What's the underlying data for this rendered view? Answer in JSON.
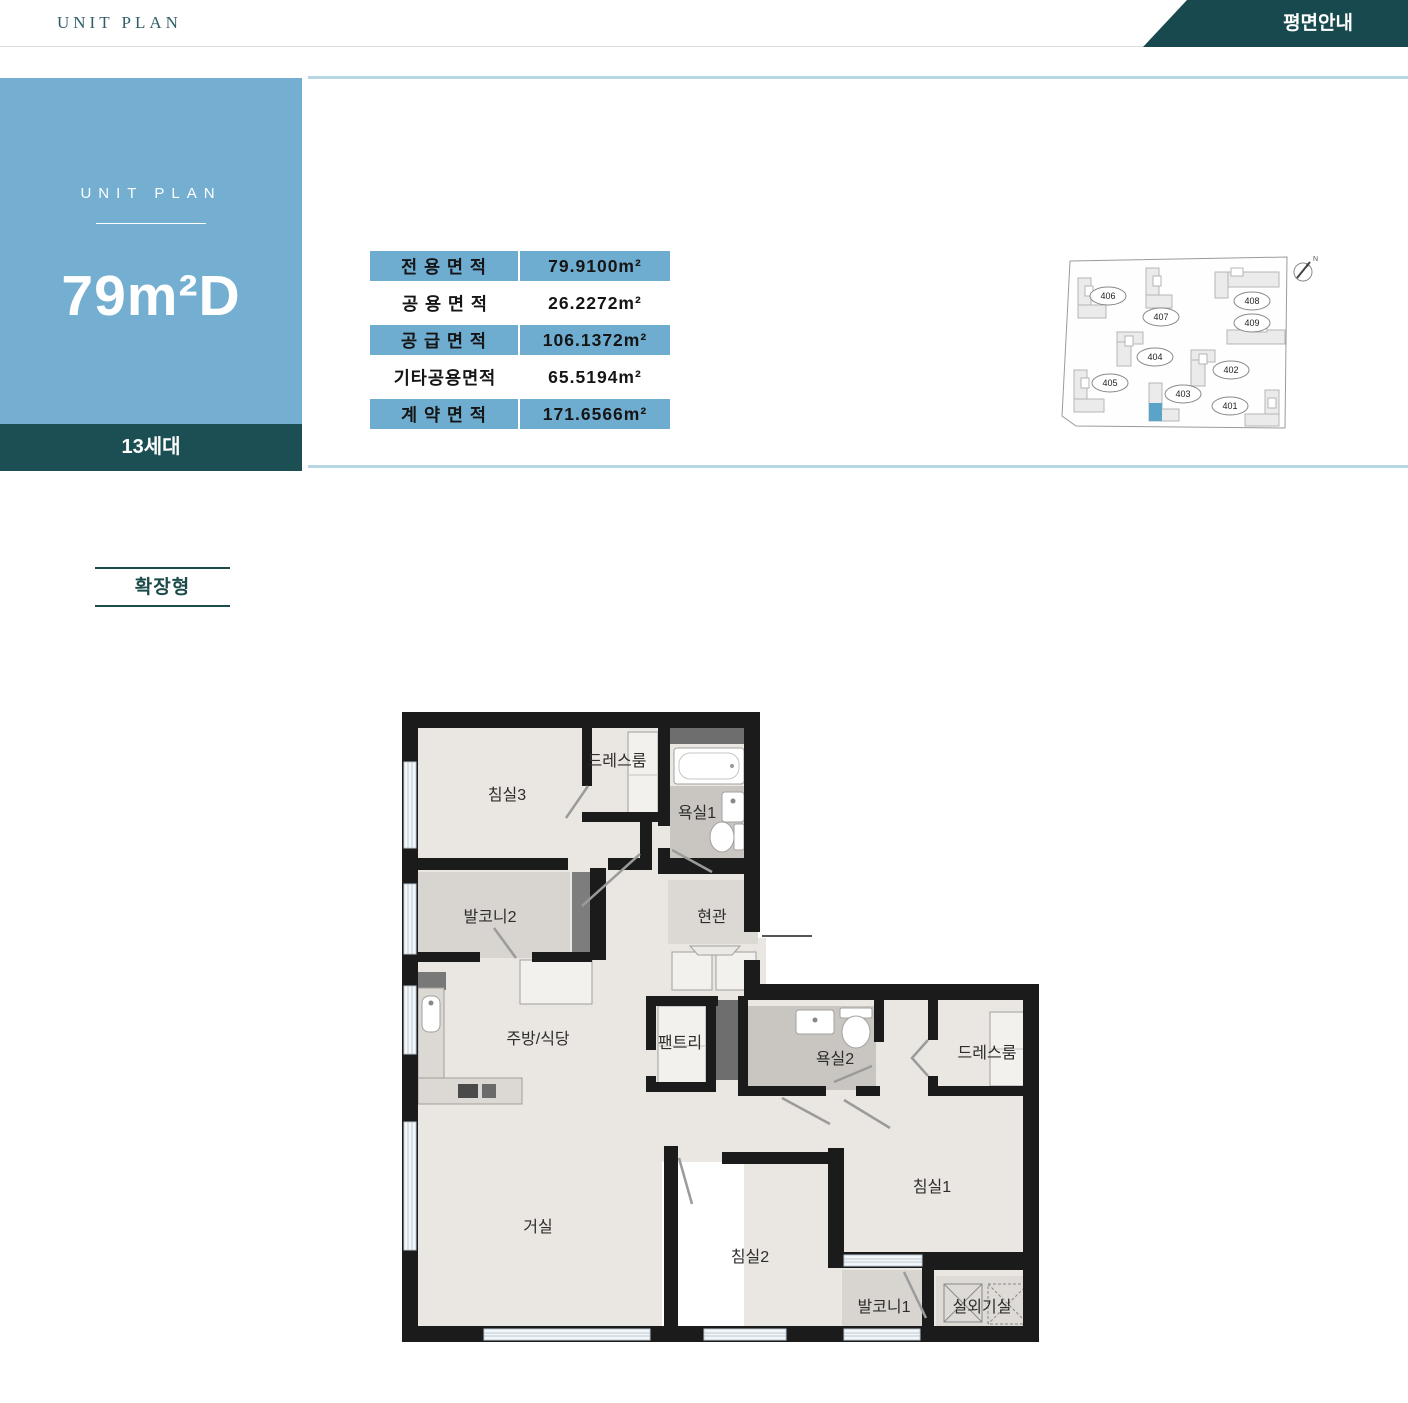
{
  "header": {
    "brand": "UNIT PLAN",
    "banner": "평면안내"
  },
  "unit_card": {
    "eyebrow": "UNIT PLAN",
    "unit_name": "79m²D",
    "households": "13세대"
  },
  "area_table": {
    "rows": [
      {
        "label": "전 용 면 적",
        "value": "79.9100m²",
        "highlighted": true
      },
      {
        "label": "공 용 면 적",
        "value": "26.2272m²",
        "highlighted": false
      },
      {
        "label": "공 급 면 적",
        "value": "106.1372m²",
        "highlighted": true
      },
      {
        "label": "기타공용면적",
        "value": "65.5194m²",
        "highlighted": false
      },
      {
        "label": "계 약 면 적",
        "value": "171.6566m²",
        "highlighted": true
      }
    ]
  },
  "site_map": {
    "compass": "N",
    "highlighted_building": "403",
    "buildings": [
      {
        "label": "401"
      },
      {
        "label": "402"
      },
      {
        "label": "403"
      },
      {
        "label": "404"
      },
      {
        "label": "405"
      },
      {
        "label": "406"
      },
      {
        "label": "407"
      },
      {
        "label": "408"
      },
      {
        "label": "409"
      }
    ]
  },
  "plan_type_label": "확장형",
  "floor_plan": {
    "rooms": [
      {
        "label": "침실3"
      },
      {
        "label": "드레스룸"
      },
      {
        "label": "욕실1"
      },
      {
        "label": "현관"
      },
      {
        "label": "발코니2"
      },
      {
        "label": "주방/식당"
      },
      {
        "label": "팬트리"
      },
      {
        "label": "욕실2"
      },
      {
        "label": "드레스룸"
      },
      {
        "label": "침실1"
      },
      {
        "label": "거실"
      },
      {
        "label": "침실2"
      },
      {
        "label": "발코니1"
      },
      {
        "label": "실외기실"
      }
    ]
  },
  "colors": {
    "accent_blue": "#74afd1",
    "table_blue": "#6fadd0",
    "teal_dark": "#1b4f53",
    "banner_teal": "#17494e",
    "light_blue_border": "#b7d6e4",
    "map_highlight": "#5ba3c9"
  }
}
